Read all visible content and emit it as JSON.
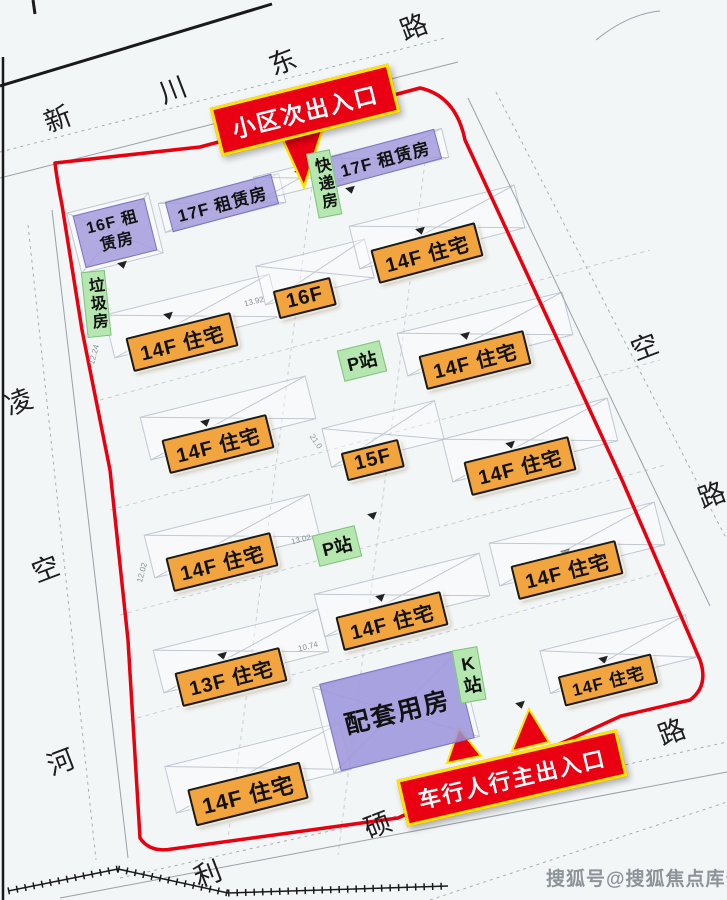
{
  "plan": {
    "callouts": {
      "secondary_entrance": "小区次出入口",
      "main_entrance": "车行人行主出入口"
    },
    "buildings": {
      "residential": [
        "14F 住宅",
        "16F",
        "14F 住宅",
        "14F 住宅",
        "15F",
        "14F 住宅",
        "14F 住宅",
        "14F 住宅",
        "14F 住宅",
        "13F 住宅",
        "14F 住宅",
        "14F 住宅",
        "14F 住宅"
      ],
      "rental": [
        "16F 租赁房",
        "17F 租赁房",
        "17F 租赁房"
      ],
      "support": "配套用房"
    },
    "facilities": {
      "express": "快递房",
      "garbage": "垃圾房",
      "p_station_1": "P站",
      "p_station_2": "P站",
      "k_station": "K站"
    },
    "streets": {
      "top": [
        "新",
        "川",
        "东",
        "路"
      ],
      "left": [
        "凌",
        "空",
        "河"
      ],
      "right": [
        "空",
        "路",
        "路"
      ],
      "bottom": [
        "利",
        "硕"
      ]
    },
    "dimensions": [
      "12.24",
      "13.92",
      "21.0",
      "13.02",
      "12.02",
      "10.74"
    ],
    "watermark": "搜狐号@搜狐焦点库安站",
    "colors": {
      "residential_label": "#F2A53E",
      "rental_label": "#A098DC",
      "facility_label": "#B6E7B1",
      "callout_red": "#E90012",
      "callout_border_yellow": "#FFE600",
      "boundary_red": "#E8000F"
    }
  }
}
